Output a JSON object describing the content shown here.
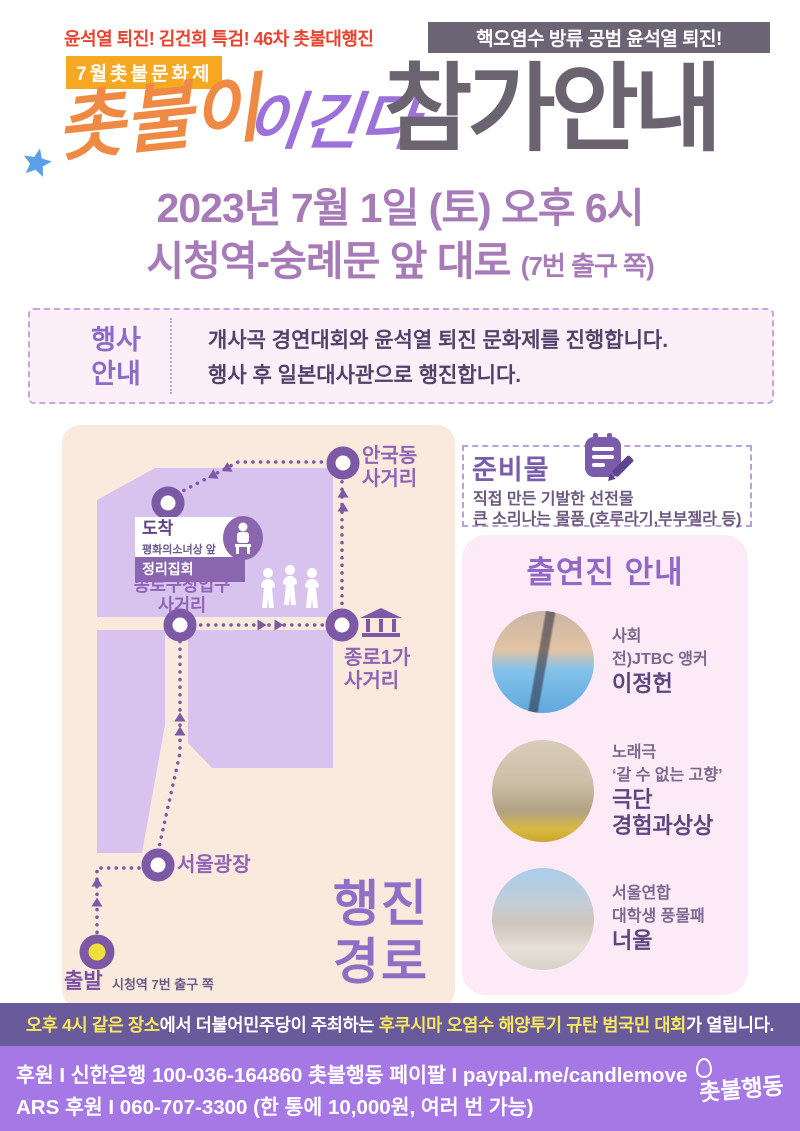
{
  "poster": {
    "top_left_line": "윤석열 퇴진! 김건희 특검! 46차 촛불대행진",
    "top_right_banner": "핵오염수 방류 공범 윤석열 퇴진!",
    "badge": "7월촛불문화제",
    "title": {
      "script": "촛불이",
      "accent": "이긴다",
      "main": "참가안내"
    },
    "schedule": {
      "line1": "2023년 7월 1일 (토) 오후 6시",
      "line2": "시청역-숭례문 앞 대로 ",
      "line2_note": "(7번 출구 쪽)"
    }
  },
  "event_info": {
    "label_line1": "행사",
    "label_line2": "안내",
    "desc_line1": "개사곡 경연대회와 윤석열 퇴진 문화제를 진행합니다.",
    "desc_line2": "행사 후 일본대사관으로 행진합니다."
  },
  "map": {
    "title_line1": "행진",
    "title_line2": "경로",
    "anguk": {
      "line1": "안국동",
      "line2": "사거리"
    },
    "arrival": {
      "label": "도착",
      "sub": "평화의소녀상 앞",
      "banner": "정리집회"
    },
    "gucheong": {
      "line1": "종로구청입구",
      "line2": "사거리"
    },
    "jongno1ga": {
      "line1": "종로1가",
      "line2": "사거리"
    },
    "plaza": {
      "label": "서울광장"
    },
    "start": {
      "label": "출발",
      "sub": "시청역 7번 출구 쪽"
    }
  },
  "supplies": {
    "title": "준비물",
    "line1": "직접 만든 기발한 선전물",
    "line2": "큰 소리나는 물품 (호루라기,부부젤라 등)"
  },
  "performers": {
    "title": "출연진 안내",
    "items": [
      {
        "role": "사회",
        "desc": "전)JTBC 앵커",
        "name_line1": "이정헌",
        "name_line2": ""
      },
      {
        "role": "노래극",
        "desc": "‘갈 수 없는 고향’",
        "name_line1": "극단",
        "name_line2": "경험과상상"
      },
      {
        "role": "서울연합",
        "desc": "대학생 풍물패",
        "name_line1": "너울",
        "name_line2": ""
      }
    ]
  },
  "notice": {
    "highlight1": "오후 4시 같은 장소",
    "text1": "에서 더불어민주당이 주최하는 ",
    "highlight2": "후쿠시마 오염수 해양투기 규탄 범국민 대회",
    "text2": "가 열립니다."
  },
  "footer": {
    "donate_label": "후원 I ",
    "donate_text": "신한은행 100-036-164860 촛불행동 ",
    "paypal_label": "페이팔 I ",
    "paypal_text": "paypal.me/candlemove",
    "ars_label": "ARS 후원 I ",
    "ars_text": "060-707-3300 (한 통에 10,000원, 여러 번 가능)",
    "logo": "촛불행동"
  },
  "colors": {
    "accent_red": "#e8432e",
    "badge_orange": "#f7a823",
    "script_orange": "#ee8a44",
    "accent_purple": "#9c72da",
    "title_gray": "#6b6470",
    "date_purple": "#a77ab8",
    "map_route_purple": "#7d58a4",
    "map_block_purple": "#d8c3ee",
    "map_panel_cream": "#faeade",
    "pink_box": "#fdeaf7",
    "notice_bg": "#695a9c",
    "footer_bg": "#a678e6",
    "highlight_yellow": "#f8e95a",
    "star_blue": "#5b9fe8",
    "star_yellow": "#f7cf4a"
  }
}
